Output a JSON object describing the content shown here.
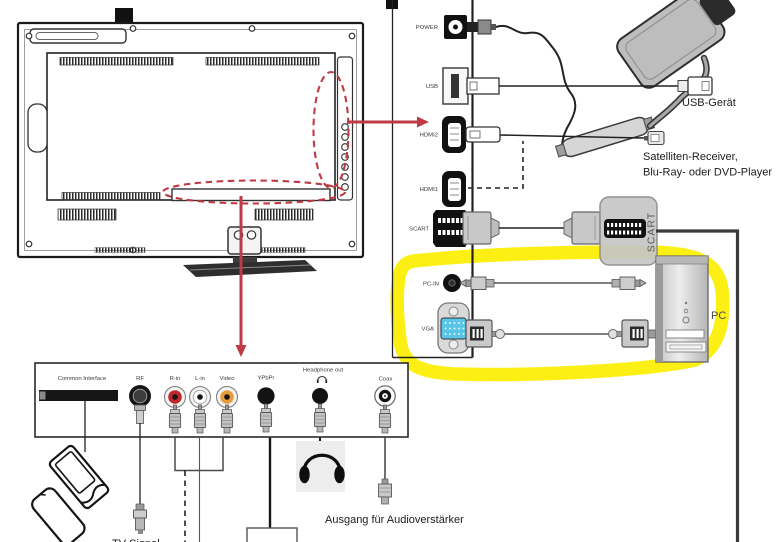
{
  "side_panel": {
    "ports": [
      {
        "id": "power",
        "label": "POWER"
      },
      {
        "id": "usb",
        "label": "USB"
      },
      {
        "id": "hdmi2",
        "label": "HDMI2"
      },
      {
        "id": "hdmi1",
        "label": "HDMI1"
      },
      {
        "id": "scart",
        "label": "SCART"
      },
      {
        "id": "pc_in",
        "label": "PC-IN"
      },
      {
        "id": "vga",
        "label": "VGA"
      }
    ]
  },
  "devices": {
    "usb_device": "USB-Gerät",
    "hdmi_source_line1": "Satelliten-Receiver,",
    "hdmi_source_line2": "Blu-Ray- oder DVD-Player",
    "scart_adapter": "SCART",
    "pc": "PC"
  },
  "bottom_panel": {
    "ports": [
      {
        "id": "common_interface",
        "label": "Common Interface"
      },
      {
        "id": "rf",
        "label": "RF"
      },
      {
        "id": "r_in",
        "label": "R-in"
      },
      {
        "id": "l_in",
        "label": "L-in"
      },
      {
        "id": "video",
        "label": "Video"
      },
      {
        "id": "ypbpr",
        "label": "YPbPr"
      },
      {
        "id": "headphone_out",
        "label": "Headphone out"
      },
      {
        "id": "coax",
        "label": "Coax"
      }
    ]
  },
  "annotations": {
    "audio_amp_output": "Ausgang für Audioverstärker",
    "tv_signal": "TV Signal"
  },
  "colors": {
    "highlight_yellow": "#fbee00",
    "arrow_red": "#c03a45",
    "vga_blue": "#59c6e8",
    "rca_red": "#c0272d",
    "rca_video_orange": "#e89b3c",
    "dark_cable": "#3a3a3a"
  }
}
